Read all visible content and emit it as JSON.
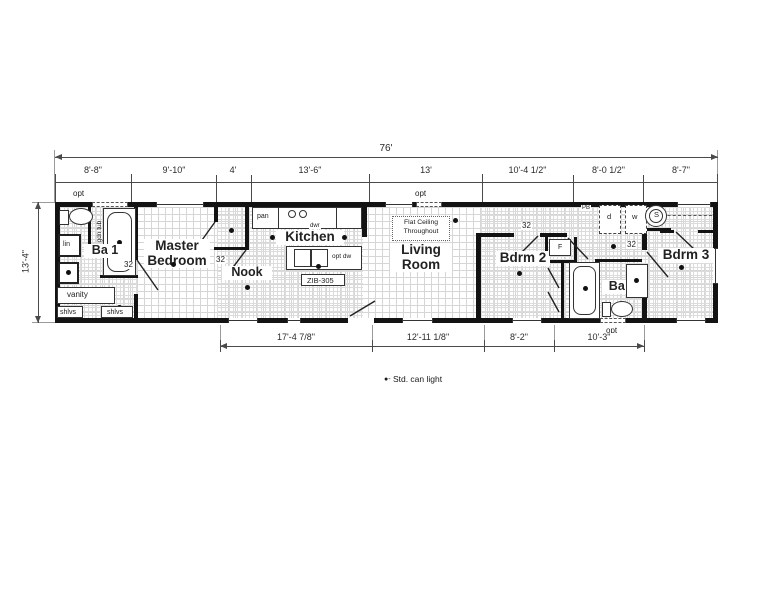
{
  "dims": {
    "overall_w": "76'",
    "overall_h": "13'-4\"",
    "top": [
      "8'-8\"",
      "9'-10\"",
      "4'",
      "13'-6\"",
      "13'",
      "10'-4 1/2\"",
      "8'-0 1/2\"",
      "8'-7\""
    ],
    "bottom": [
      "17'-4 7/8\"",
      "12'-11 1/8\"",
      "8'-2\"",
      "10'-3\""
    ]
  },
  "rooms": {
    "master": "Master Bedroom",
    "ba1": "Ba 1",
    "nook": "Nook",
    "kitchen": "Kitchen",
    "living": "Living Room",
    "bdrm2": "Bdrm 2",
    "ba2": "Ba 2",
    "bdrm3": "Bdrm 3"
  },
  "notes": {
    "flat_ceiling": "Flat Ceiling Throughout",
    "island_model": "ZIB-305"
  },
  "labels": {
    "opt": "opt",
    "pan": "pan",
    "dwr": "dwr",
    "opt_dw": "opt dw",
    "lin": "lin",
    "vanity": "vanity",
    "shlvs": "shlvs",
    "opt_gdn_tub": "opt gdn tub",
    "pb": "PB",
    "dryer": "d",
    "washer": "w",
    "water_heater": "S",
    "furnace": "F",
    "door_32": "32"
  },
  "legend": {
    "symbol": "●",
    "sep": "-",
    "text": "Std. can light"
  }
}
